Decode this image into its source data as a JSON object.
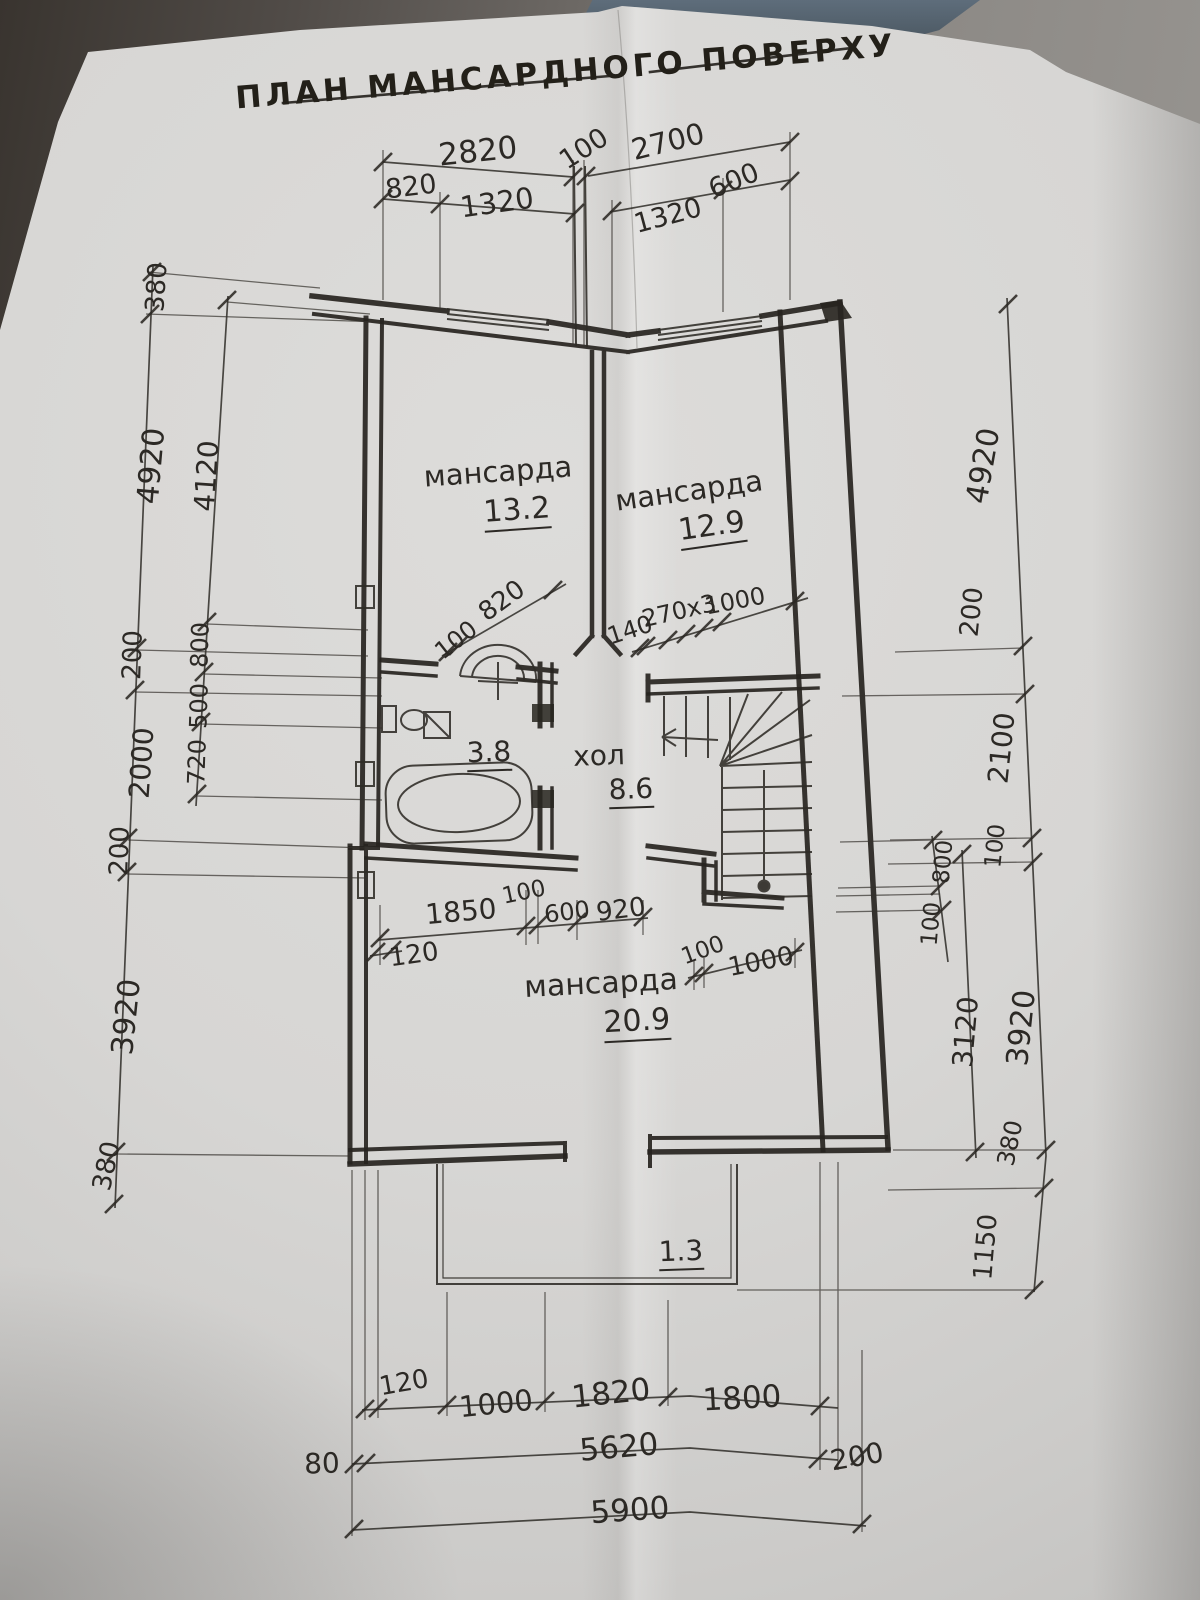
{
  "title": {
    "text": "ПЛАН МАНСАРДНОГО ПОВЕРХУ"
  },
  "rooms": [
    {
      "name": "мансарда",
      "area": "13.2"
    },
    {
      "name": "мансарда",
      "area": "12.9"
    },
    {
      "name": "хол",
      "area": "8.6"
    },
    {
      "name": "санвузол",
      "area": "3.8"
    },
    {
      "name": "мансарда",
      "area": "20.9"
    },
    {
      "name": "балкон",
      "area": "1.3"
    }
  ],
  "dimensions": {
    "top_chain": [
      "2820",
      "100",
      "2700",
      "820",
      "1320",
      "1320",
      "600"
    ],
    "left_outer_chain": [
      "380",
      "4920",
      "200",
      "2000",
      "200",
      "3920",
      "380"
    ],
    "left_inner_chain": [
      "4120",
      "800",
      "500",
      "720"
    ],
    "right_outer_chain": [
      "4920",
      "200",
      "2100",
      "100",
      "3920",
      "380",
      "1150"
    ],
    "right_inner_chain": [
      "800",
      "100",
      "3120"
    ],
    "interior_dims": [
      "100",
      "820",
      "140",
      "270x3",
      "1000",
      "1850",
      "100",
      "600",
      "920",
      "120",
      "100",
      "1000"
    ],
    "bottom_chain": [
      "120",
      "1000",
      "1820",
      "1800",
      "5620",
      "80",
      "200",
      "5900"
    ]
  },
  "labels": [
    {
      "t": "2820",
      "x": 478,
      "y": 152,
      "r": -6,
      "s": 31
    },
    {
      "t": "100",
      "x": 584,
      "y": 149,
      "r": -33,
      "s": 27
    },
    {
      "t": "2700",
      "x": 668,
      "y": 142,
      "r": -14,
      "s": 29
    },
    {
      "t": "820",
      "x": 411,
      "y": 187,
      "r": -7,
      "s": 27
    },
    {
      "t": "1320",
      "x": 497,
      "y": 203,
      "r": -8,
      "s": 29
    },
    {
      "t": "1320",
      "x": 668,
      "y": 216,
      "r": -15,
      "s": 27
    },
    {
      "t": "600",
      "x": 734,
      "y": 181,
      "r": -22,
      "s": 27
    },
    {
      "t": "380",
      "x": 157,
      "y": 287,
      "r": -86,
      "s": 26
    },
    {
      "t": "4920",
      "x": 152,
      "y": 466,
      "r": -85,
      "s": 30
    },
    {
      "t": "200",
      "x": 133,
      "y": 655,
      "r": -88,
      "s": 26
    },
    {
      "t": "2000",
      "x": 142,
      "y": 763,
      "r": -86,
      "s": 28
    },
    {
      "t": "200",
      "x": 120,
      "y": 851,
      "r": -88,
      "s": 26
    },
    {
      "t": "3920",
      "x": 127,
      "y": 1017,
      "r": -84,
      "s": 30
    },
    {
      "t": "380",
      "x": 107,
      "y": 1166,
      "r": -78,
      "s": 26
    },
    {
      "t": "4120",
      "x": 207,
      "y": 476,
      "r": -86,
      "s": 28
    },
    {
      "t": "800",
      "x": 200,
      "y": 645,
      "r": -88,
      "s": 24
    },
    {
      "t": "500",
      "x": 199,
      "y": 706,
      "r": -88,
      "s": 24
    },
    {
      "t": "720",
      "x": 197,
      "y": 762,
      "r": -88,
      "s": 24
    },
    {
      "t": "4920",
      "x": 984,
      "y": 466,
      "r": -80,
      "s": 30
    },
    {
      "t": "200",
      "x": 972,
      "y": 612,
      "r": -84,
      "s": 26
    },
    {
      "t": "2100",
      "x": 1002,
      "y": 748,
      "r": -84,
      "s": 28
    },
    {
      "t": "100",
      "x": 996,
      "y": 846,
      "r": -84,
      "s": 23
    },
    {
      "t": "800",
      "x": 944,
      "y": 862,
      "r": -85,
      "s": 23
    },
    {
      "t": "100",
      "x": 932,
      "y": 924,
      "r": -85,
      "s": 23
    },
    {
      "t": "3120",
      "x": 966,
      "y": 1032,
      "r": -85,
      "s": 28
    },
    {
      "t": "3920",
      "x": 1022,
      "y": 1028,
      "r": -84,
      "s": 30
    },
    {
      "t": "380",
      "x": 1010,
      "y": 1143,
      "r": -78,
      "s": 24
    },
    {
      "t": "1150",
      "x": 986,
      "y": 1247,
      "r": -85,
      "s": 26
    },
    {
      "t": "100",
      "x": 456,
      "y": 640,
      "r": -38,
      "s": 24
    },
    {
      "t": "820",
      "x": 502,
      "y": 601,
      "r": -36,
      "s": 26
    },
    {
      "t": "140",
      "x": 630,
      "y": 630,
      "r": -18,
      "s": 24
    },
    {
      "t": "270x3",
      "x": 679,
      "y": 611,
      "r": -13,
      "s": 24
    },
    {
      "t": "1000",
      "x": 735,
      "y": 601,
      "r": -11,
      "s": 24
    },
    {
      "t": "1850",
      "x": 461,
      "y": 912,
      "r": -5,
      "s": 28
    },
    {
      "t": "100",
      "x": 524,
      "y": 893,
      "r": -12,
      "s": 23
    },
    {
      "t": "600",
      "x": 567,
      "y": 912,
      "r": -7,
      "s": 24
    },
    {
      "t": "920",
      "x": 621,
      "y": 910,
      "r": -7,
      "s": 26
    },
    {
      "t": "120",
      "x": 414,
      "y": 955,
      "r": -8,
      "s": 26
    },
    {
      "t": "100",
      "x": 703,
      "y": 951,
      "r": -20,
      "s": 23
    },
    {
      "t": "1000",
      "x": 761,
      "y": 962,
      "r": -11,
      "s": 26
    },
    {
      "t": "120",
      "x": 404,
      "y": 1383,
      "r": -10,
      "s": 26
    },
    {
      "t": "1000",
      "x": 496,
      "y": 1404,
      "r": -6,
      "s": 29
    },
    {
      "t": "1820",
      "x": 611,
      "y": 1394,
      "r": -6,
      "s": 31
    },
    {
      "t": "1800",
      "x": 742,
      "y": 1399,
      "r": -3,
      "s": 31
    },
    {
      "t": "5620",
      "x": 619,
      "y": 1448,
      "r": -5,
      "s": 31
    },
    {
      "t": "80",
      "x": 322,
      "y": 1464,
      "r": -2,
      "s": 28
    },
    {
      "t": "200",
      "x": 857,
      "y": 1457,
      "r": -10,
      "s": 28
    },
    {
      "t": "5900",
      "x": 630,
      "y": 1511,
      "r": -4,
      "s": 31
    },
    {
      "t": "мансарда",
      "x": 498,
      "y": 472,
      "r": -4,
      "s": 29,
      "n": "room-label-mansarda-1"
    },
    {
      "t": "13.2",
      "x": 517,
      "y": 513,
      "r": -4,
      "s": 30,
      "u": true,
      "n": "room-area-13-2"
    },
    {
      "t": "мансарда",
      "x": 689,
      "y": 491,
      "r": -8,
      "s": 29,
      "n": "room-label-mansarda-2"
    },
    {
      "t": "12.9",
      "x": 712,
      "y": 529,
      "r": -8,
      "s": 30,
      "u": true,
      "n": "room-area-12-9"
    },
    {
      "t": "3.8",
      "x": 489,
      "y": 755,
      "r": -2,
      "s": 28,
      "u": true,
      "n": "room-area-3-8"
    },
    {
      "t": "хол",
      "x": 599,
      "y": 756,
      "r": -2,
      "s": 28,
      "n": "room-label-hol"
    },
    {
      "t": "8.6",
      "x": 631,
      "y": 792,
      "r": -2,
      "s": 28,
      "u": true,
      "n": "room-area-8-6"
    },
    {
      "t": "мансарда",
      "x": 601,
      "y": 984,
      "r": -3,
      "s": 30,
      "n": "room-label-mansarda-3"
    },
    {
      "t": "20.9",
      "x": 637,
      "y": 1024,
      "r": -3,
      "s": 30,
      "u": true,
      "n": "room-area-20-9"
    },
    {
      "t": "1.3",
      "x": 681,
      "y": 1254,
      "r": -2,
      "s": 28,
      "u": true,
      "n": "room-area-1-3"
    }
  ]
}
